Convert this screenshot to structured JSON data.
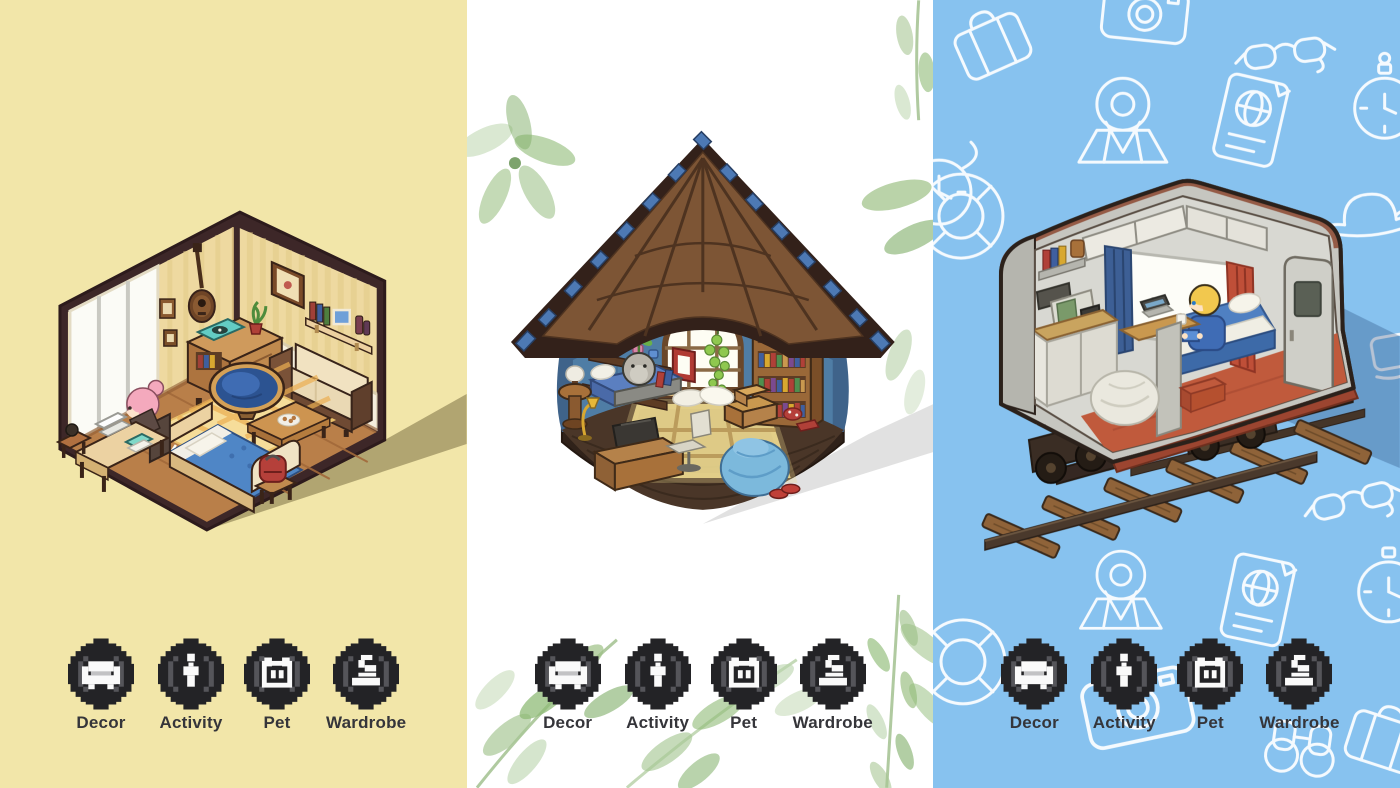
{
  "menu": {
    "items": [
      {
        "label": "Decor",
        "icon": "sofa-icon"
      },
      {
        "label": "Activity",
        "icon": "person-icon"
      },
      {
        "label": "Pet",
        "icon": "pet-face-icon"
      },
      {
        "label": "Wardrobe",
        "icon": "mannequin-icon"
      }
    ]
  },
  "panels": [
    {
      "name": "bedroom",
      "scene": "pixel-art isometric bedroom with pink-haired character at desk, blue bed, papasan chair, cream sofa and record cabinet",
      "background": "#f2e6a9",
      "shadow": "dark-olive"
    },
    {
      "name": "forest-hut",
      "scene": "pixel-art thatched-roof hut with arched window, bookshelf, daybed with grey pet, desk and blue bean bag, framed by watercolor leaves",
      "background": "#ffffff",
      "shadow": "light-grey"
    },
    {
      "name": "train-car",
      "scene": "pixel-art cutaway sleeper train car on wooden tracks with blonde character, travel-doodle pattern background",
      "background": "#87c2ef",
      "shadow": "dark-blue"
    }
  ],
  "colors": {
    "bedroom_bg": "#f2e6a9",
    "hut_bg": "#ffffff",
    "train_bg": "#87c2ef",
    "wallpaper": "#eed9a0",
    "hut_wall_blue": "#4f7da5",
    "train_floor_red": "#c05a3c",
    "button_fill": "#232326",
    "button_bracket": "#55555a",
    "button_glyph": "#fafafa",
    "label_text": "#35353a"
  }
}
